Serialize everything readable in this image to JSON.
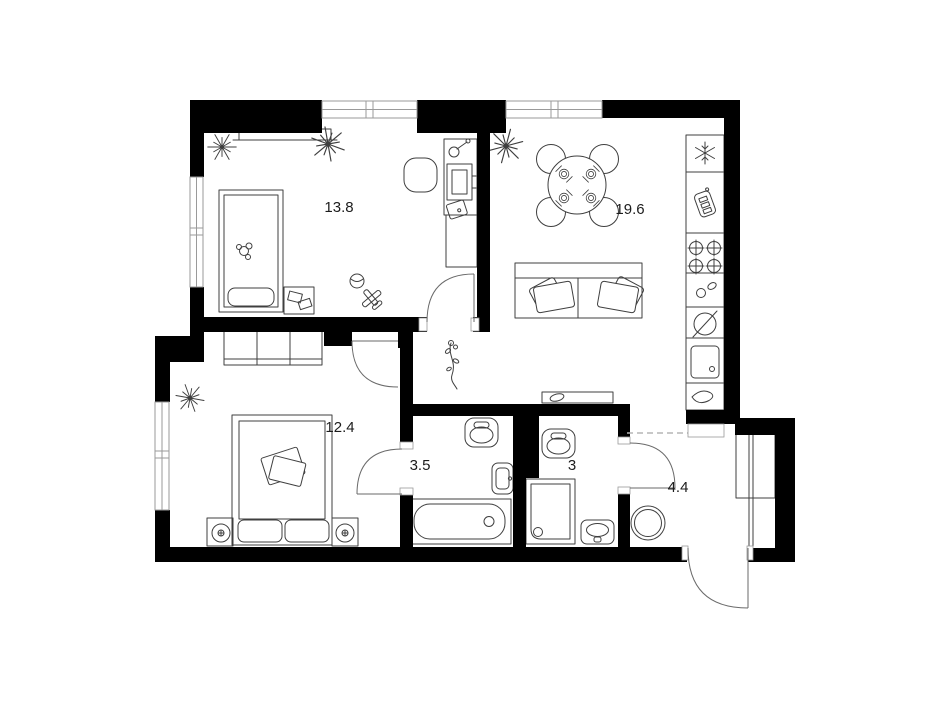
{
  "title": "apartment-floor-plan",
  "canvas": {
    "width": 950,
    "height": 712,
    "background": "#ffffff"
  },
  "colors": {
    "wall": "#000000",
    "furniture_line": "#3f3f3f",
    "window_line": "#9a9a9a",
    "door_line": "#6a6a6a",
    "dashed_line": "#b5b5b5",
    "label": "#1c1c1c"
  },
  "rooms": [
    {
      "name": "bedroom-1",
      "area_label": "13.8",
      "furniture": [
        "single-bed",
        "pillow",
        "teddy-bear",
        "wall-shelf",
        "star-plant",
        "orchid-plant",
        "nightstand",
        "books",
        "desk",
        "desk-chair",
        "desk-lamp",
        "monitor",
        "drawer-unit",
        "toy-ball",
        "toy-airplane",
        "window",
        "door"
      ]
    },
    {
      "name": "living-room-kitchen",
      "area_label": "19.6",
      "furniture": [
        "orchid-plant",
        "round-dining-table",
        "chairs-4",
        "place-settings-4",
        "sofa",
        "sofa-pillows",
        "fridge-freezer",
        "tall-cabinet",
        "cooktop-4-burners",
        "counter-accessories",
        "round-appliance",
        "kitchen-sink",
        "decor-drop",
        "window"
      ]
    },
    {
      "name": "bedroom-2",
      "area_label": "12.4",
      "furniture": [
        "double-bed",
        "pillows-2",
        "blanket",
        "wardrobe-3-section",
        "nightstand-left",
        "nightstand-right",
        "table-lamp-left",
        "table-lamp-right",
        "star-plant",
        "window",
        "door"
      ]
    },
    {
      "name": "bathroom",
      "area_label": "3.5",
      "furniture": [
        "toilet",
        "washbasin",
        "bathtub",
        "door"
      ]
    },
    {
      "name": "shower-room",
      "area_label": "3",
      "furniture": [
        "toilet",
        "shower-cabin",
        "washbasin",
        "console-shelf",
        "door"
      ]
    },
    {
      "name": "hallway",
      "area_label": "4.4",
      "furniture": [
        "pouf",
        "wardrobe",
        "closet-rail",
        "dried-flowers-decor",
        "entrance-door",
        "dashed-opening",
        "wall-niche"
      ]
    }
  ],
  "windows": [
    "top-bedroom-1",
    "top-living-kitchen",
    "left-bedroom-1",
    "left-bedroom-2"
  ],
  "doors": [
    "bedroom-1-door",
    "bedroom-2-door",
    "bathroom-door",
    "shower-room-door",
    "entrance-door"
  ]
}
